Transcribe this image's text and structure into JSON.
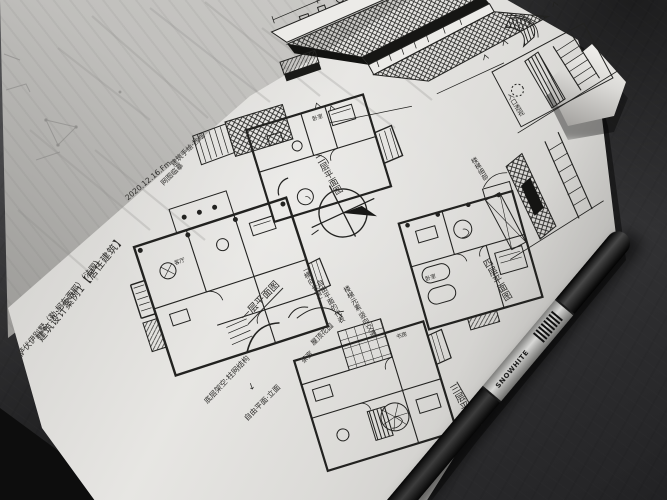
{
  "page": {
    "title_line1": "建筑设计案例1【居住建筑】",
    "title_line2": "萨伏伊别墅（勒·柯布西耶）（法国）",
    "date": "2020.12.16.Fm",
    "note_line1": "建筑手绘·抄绘",
    "note_line2": "网图临摹",
    "plan_labels": {
      "p1": "一层平面图",
      "p2": "二层平面图",
      "p3": "三层平面图",
      "p4": "四层平面图"
    },
    "annotations": {
      "pilotis": "底层架空·柱网结构",
      "free_plan": "自由平面·立面",
      "down_arrow": "↓",
      "ribbon_window": "「横向长窗」",
      "free_plan_rep": "自由平面的代表",
      "stairs_note": "楼梯元素·竖向交通",
      "roof_garden": "屋顶花园",
      "tea_room": "茶室",
      "detail_cap1": "入口透视",
      "detail_cap2": "楼梯细部"
    },
    "rooms": {
      "bedroom": "卧室",
      "living": "客厅",
      "study": "书房"
    }
  },
  "pen": {
    "brand": "SNOWHITE"
  },
  "colors": {
    "ink": "#2a2a28",
    "paper": "#e7e6e3",
    "desk": "#3b3b3d",
    "pen_band": "#c9c9c7"
  }
}
